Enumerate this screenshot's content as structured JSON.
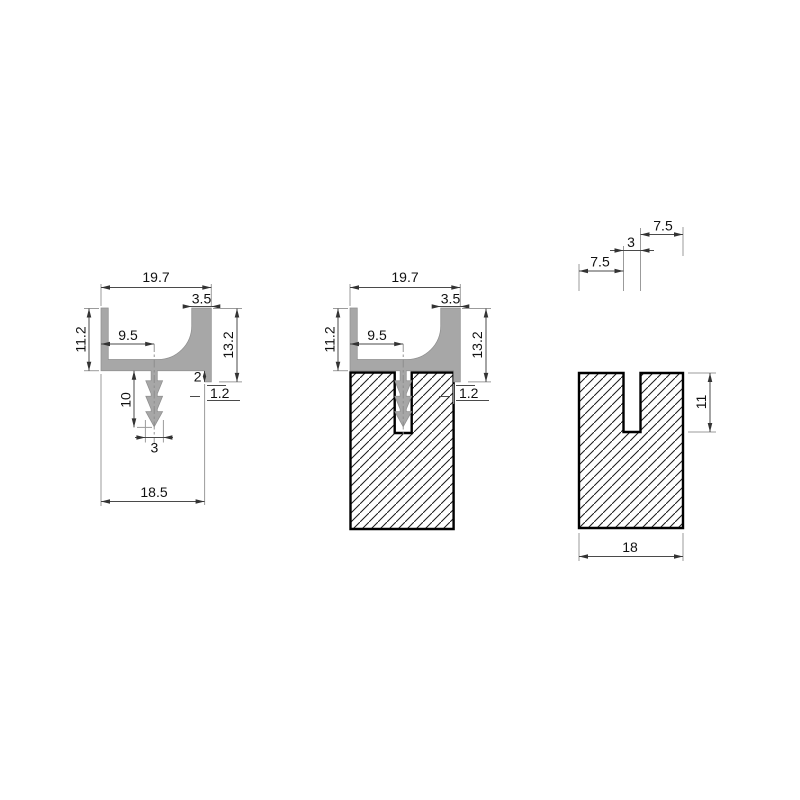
{
  "drawing": {
    "type": "technical-cross-section",
    "description": "Three views: aluminium channel profile with barbed anchor stem, profile installed in slotted block, and slotted block alone",
    "colors": {
      "background": "#ffffff",
      "profile_fill": "#a7a7a7",
      "block_outline": "#000000",
      "dimension_line": "#4a4a4a",
      "extension_line": "#9b9b9b",
      "text": "#111111"
    },
    "views": {
      "left": {
        "name": "profile-section",
        "dims": {
          "overall_width": "19.7",
          "flange_width": "3.5",
          "wall_height": "11.2",
          "stem_offset": "9.5",
          "total_height": "13.2",
          "step_depth": "2",
          "lip_width": "1.2",
          "stem_length": "10",
          "stem_width": "3",
          "base_width": "18.5"
        }
      },
      "middle": {
        "name": "profile-installed-in-block",
        "dims": {
          "overall_width": "19.7",
          "flange_width": "3.5",
          "wall_height": "11.2",
          "stem_offset": "9.5",
          "total_height": "13.2",
          "lip_width": "1.2"
        }
      },
      "right": {
        "name": "slotted-block-section",
        "dims": {
          "shoulder_left": "7.5",
          "slot_width": "3",
          "shoulder_right": "7.5",
          "slot_depth": "11",
          "block_width": "18"
        }
      }
    }
  }
}
